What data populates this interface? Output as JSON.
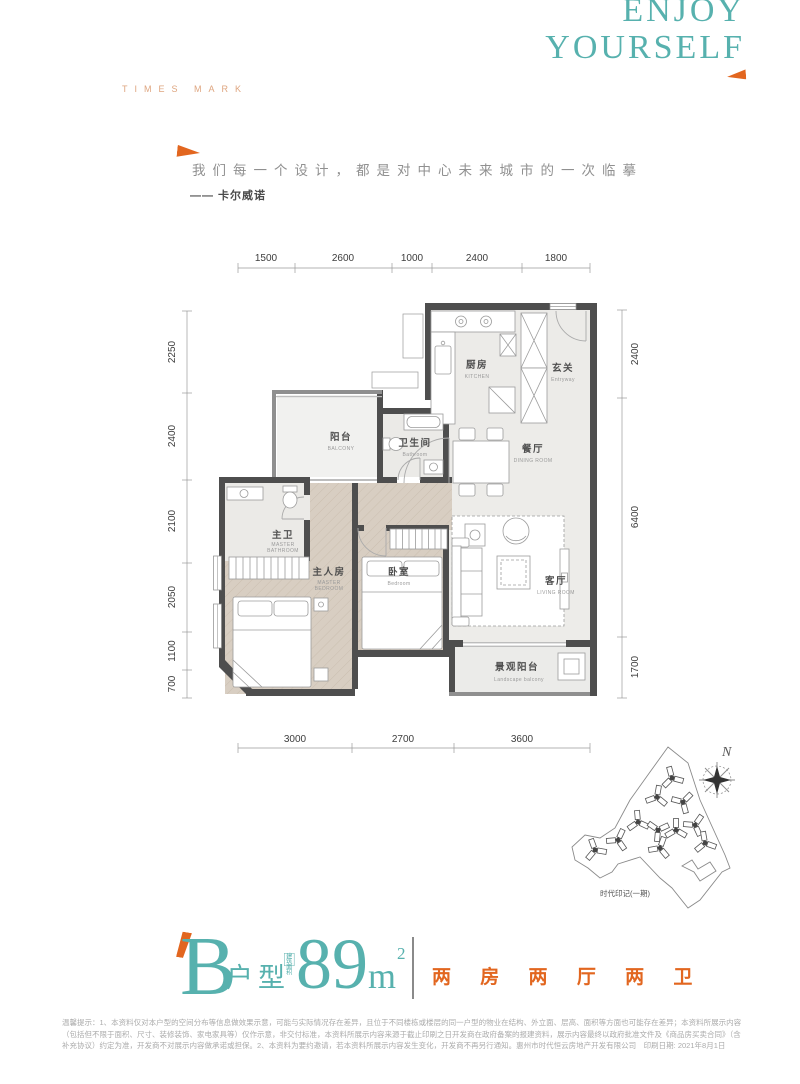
{
  "header": {
    "brand": "TIMES MARK",
    "slogan_en_line1": "ENJOY",
    "slogan_en_line2": "YOURSELF"
  },
  "quote": {
    "text": "我们每一个设计，都是对中心未来城市的一次临摹",
    "author": "—— 卡尔威诺"
  },
  "floorplan": {
    "dims_top": [
      "1500",
      "2600",
      "1000",
      "2400",
      "1800"
    ],
    "dims_left": [
      "2250",
      "2400",
      "2100",
      "2050",
      "1100",
      "700"
    ],
    "dims_right": [
      "2400",
      "6400",
      "1700"
    ],
    "dims_bottom": [
      "3000",
      "2700",
      "3600"
    ],
    "rooms": {
      "kitchen": {
        "cn": "厨房",
        "en": "KITCHEN"
      },
      "entry": {
        "cn": "玄关",
        "en": "Entryway"
      },
      "balcony": {
        "cn": "阳台",
        "en": "BALCONY"
      },
      "bathroom": {
        "cn": "卫生间",
        "en": "Bathroom"
      },
      "dining": {
        "cn": "餐厅",
        "en": "DINING ROOM"
      },
      "master_bath": {
        "cn": "主卫",
        "en1": "MASTER",
        "en2": "BATHROOM"
      },
      "master_bed": {
        "cn": "主人房",
        "en1": "MASTER",
        "en2": "BEDROOM"
      },
      "bedroom": {
        "cn": "卧室",
        "en": "Bedroom"
      },
      "living": {
        "cn": "客厅",
        "en": "LIVING ROOM"
      },
      "landscape": {
        "cn": "景观阳台",
        "en": "Landscape balcony"
      }
    }
  },
  "siteplan": {
    "north_label": "N",
    "caption": "时代印记(一期)"
  },
  "title_block": {
    "type_letter": "B",
    "type_suffix": "户型",
    "area_badge": "建筑\n面积",
    "area_number": "89",
    "area_unit": "m",
    "area_sup": "2",
    "layout_text": "两 房 两 厅 两 卫"
  },
  "disclaimer": {
    "line1": "温馨提示：1、本资料仅对本户型的空间分布等信息做效果示意，可能与实际情况存在差异，且位于不同楼栋或楼层的同一户型的物业在结构、外立面、层高、面积等方面也可能存在差异；本资料所展示内容",
    "line2": "（包括但不限于面积、尺寸、装修装饰、家电家具等）仅作示意，非交付标准，本资料所展示内容来源于截止印刷之日开发商在政府备案的报建资料，展示内容最终以政府批准文件及《商品房买卖合同》（含",
    "line3": "补充协议）约定为准，开发商不对展示内容做承诺或担保。2、本资料为要约邀请，若本资料所展示内容发生变化，开发商不再另行通知。惠州市时代恒云房地产开发有限公司　印刷日期: 2021年8月1日"
  },
  "colors": {
    "teal": "#57b1ae",
    "orange": "#e2661f",
    "orange_light": "#dea57f"
  }
}
